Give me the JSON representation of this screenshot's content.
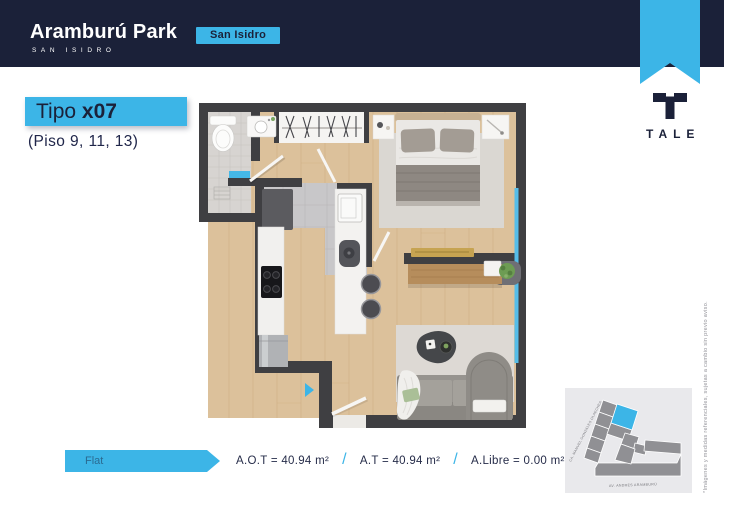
{
  "header": {
    "brand_title": "Aramburú Park",
    "brand_subtitle": "SAN ISIDRO",
    "location_badge": "San Isidro"
  },
  "developer": {
    "logo_text": "TALE"
  },
  "unit": {
    "type_prefix": "Tipo ",
    "type_code": "x07",
    "floors_note": "(Piso 9, 11, 13)"
  },
  "summary": {
    "flat_label": "Flat",
    "separator": "/",
    "areas": [
      "A.O.T = 40.94 m²",
      "A.T = 40.94 m²",
      "A.Libre = 0.00 m²"
    ]
  },
  "map": {
    "street_side": "CA. MANUEL GONZÁLES OLAECHEA",
    "street_bottom": "AV. ANDRÉS ARAMBURÚ"
  },
  "legal": {
    "disclaimer": "*Imágenes y medidas referenciales, sujetas a cambio sin previo aviso."
  },
  "floorplan_features": [
    "bathroom",
    "closet",
    "bedroom",
    "kitchen",
    "living-room",
    "entry"
  ],
  "colors": {
    "navy": "#1b2139",
    "cyan": "#3cb5e7"
  }
}
